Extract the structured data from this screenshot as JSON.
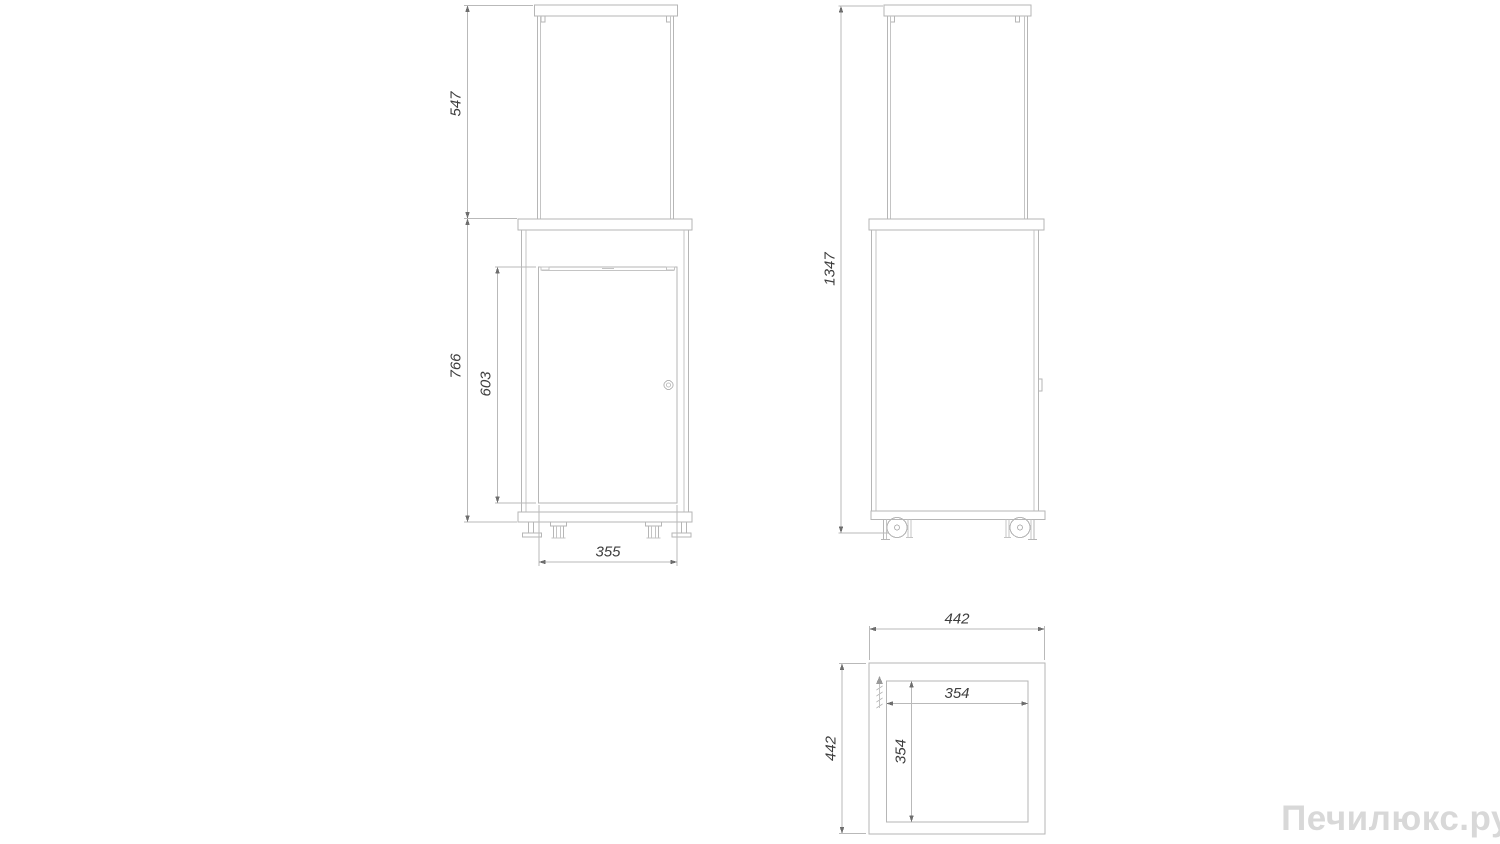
{
  "watermark": {
    "text": "Печилюкс.ру",
    "color": "#d8d8d8"
  },
  "colors": {
    "background": "#ffffff",
    "line": "#b6b6b6",
    "dimension_text": "#3e3e3e",
    "arrow": "#6e6e6e"
  },
  "views": {
    "front": {
      "name": "front-view",
      "dimensions": {
        "glass_section_height": "547",
        "body_height": "766",
        "door_height": "603",
        "door_width": "355"
      }
    },
    "side": {
      "name": "side-view",
      "dimensions": {
        "overall_height": "1347"
      }
    },
    "top": {
      "name": "top-view",
      "dimensions": {
        "overall_width": "442",
        "overall_depth": "442",
        "inner_width": "354",
        "inner_depth": "354"
      }
    }
  }
}
